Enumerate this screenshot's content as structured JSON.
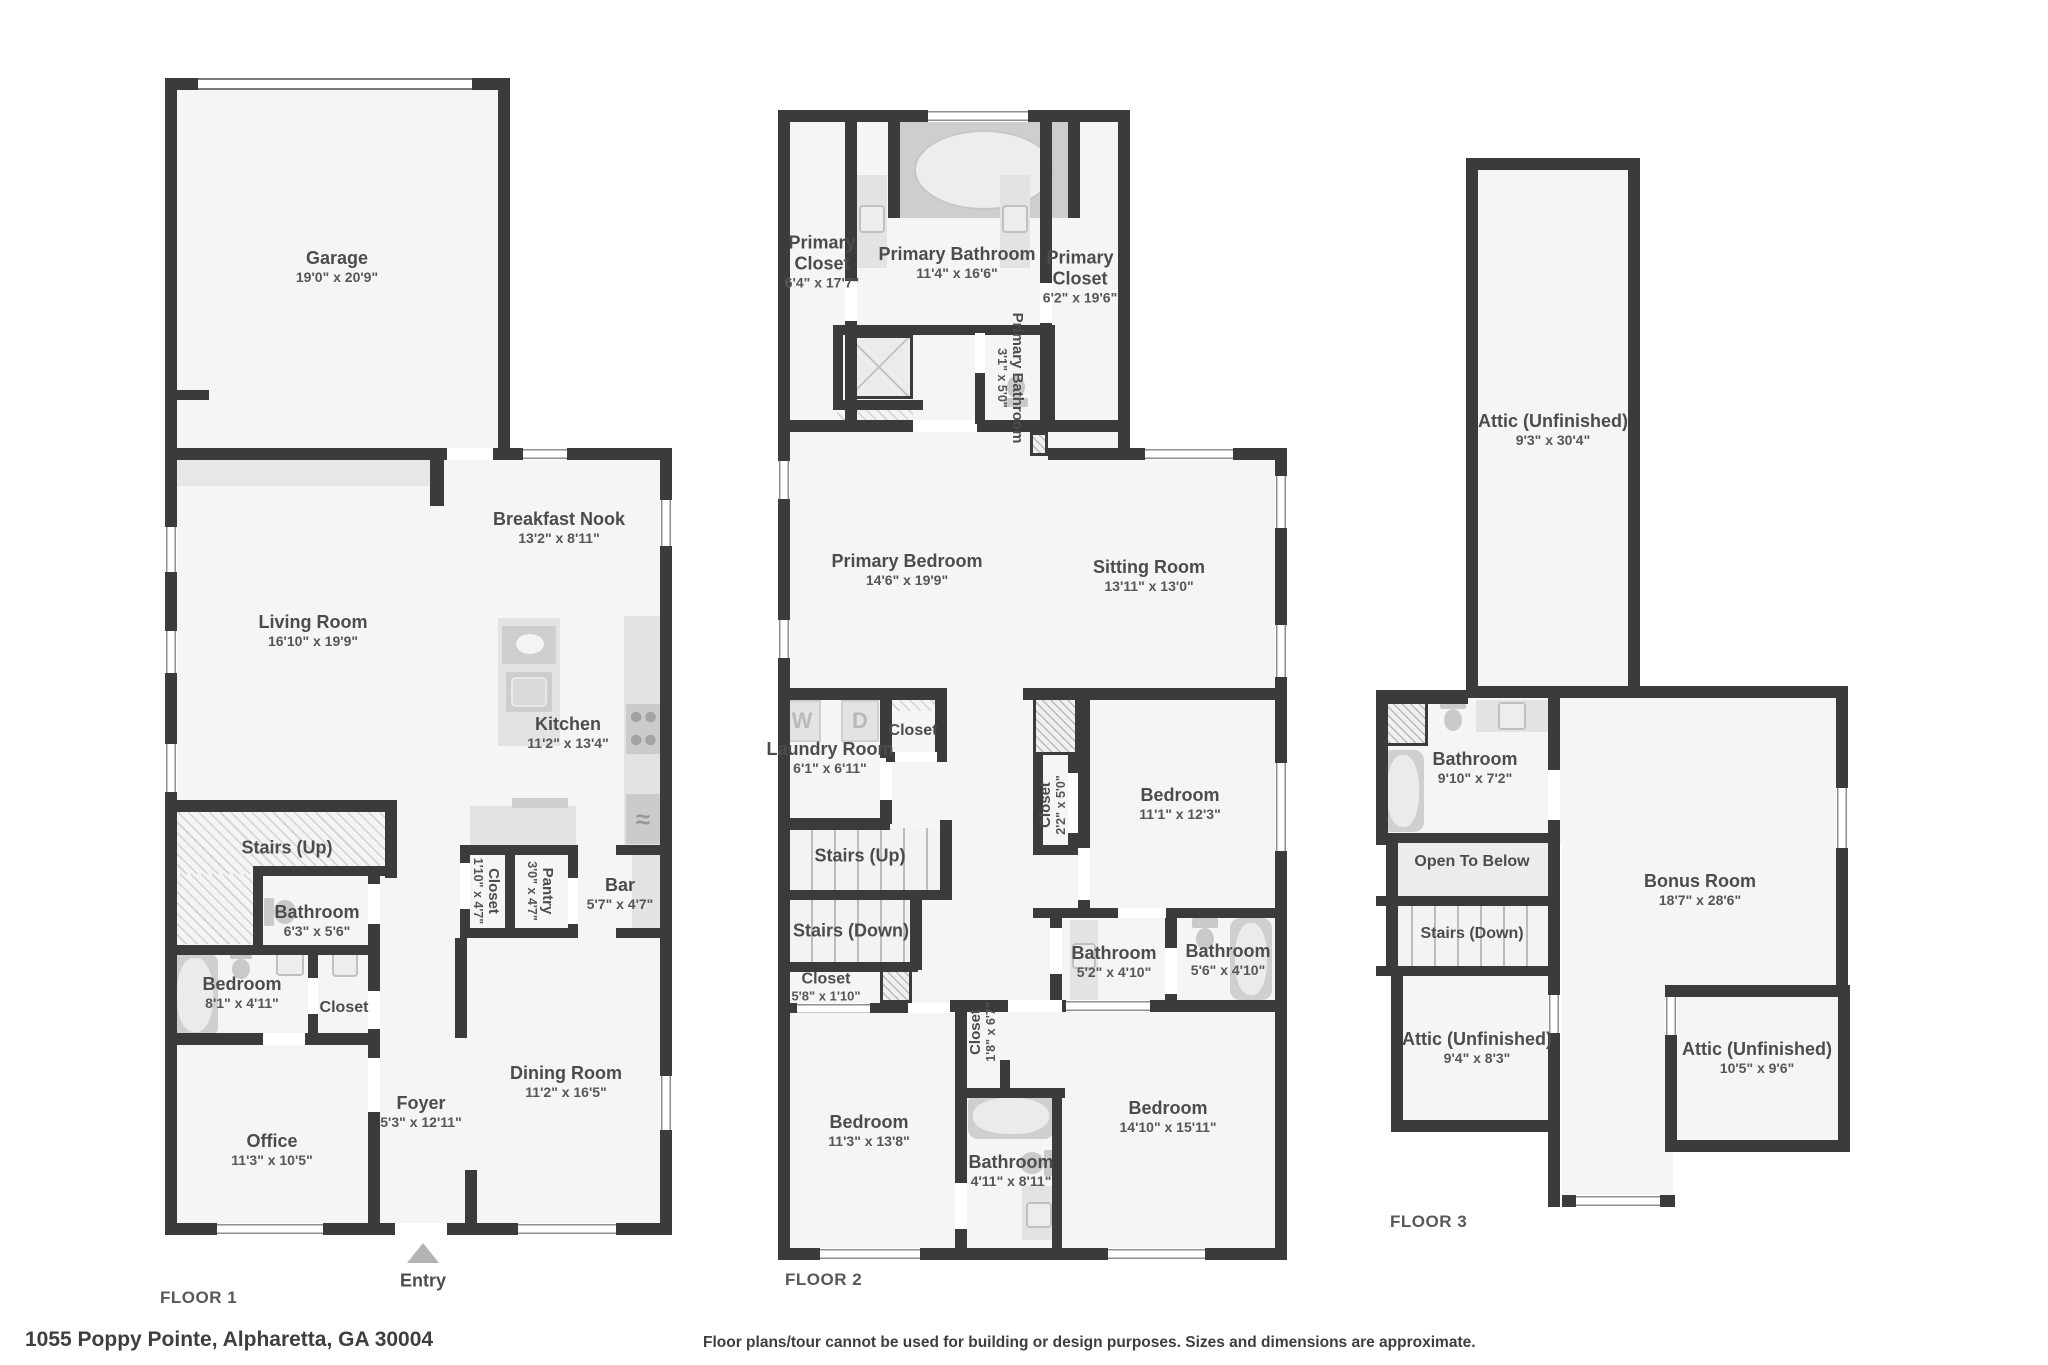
{
  "address": "1055 Poppy Pointe, Alpharetta, GA 30004",
  "disclaimer": "Floor plans/tour cannot be used for building or design purposes. Sizes and dimensions are approximate.",
  "icons": {
    "washer": "W",
    "dryer": "D",
    "fridge": "≈"
  },
  "f1": {
    "caption": "FLOOR 1",
    "entry": "Entry",
    "garage": {
      "name": "Garage",
      "dims": "19'0\" x 20'9\""
    },
    "breakfast_nook": {
      "name": "Breakfast Nook",
      "dims": "13'2\" x 8'11\""
    },
    "living_room": {
      "name": "Living Room",
      "dims": "16'10\" x 19'9\""
    },
    "kitchen": {
      "name": "Kitchen",
      "dims": "11'2\" x 13'4\""
    },
    "stairs_up": {
      "name": "Stairs (Up)"
    },
    "bathroom": {
      "name": "Bathroom",
      "dims": "6'3\" x 5'6\""
    },
    "bedroom": {
      "name": "Bedroom",
      "dims": "8'1\" x 4'11\""
    },
    "closet": {
      "name": "Closet"
    },
    "closet2": {
      "name": "Closet",
      "dims": "1'10\" x 4'7\""
    },
    "pantry": {
      "name": "Pantry",
      "dims": "3'0\" x 4'7\""
    },
    "bar": {
      "name": "Bar",
      "dims": "5'7\" x 4'7\""
    },
    "office": {
      "name": "Office",
      "dims": "11'3\" x 10'5\""
    },
    "foyer": {
      "name": "Foyer",
      "dims": "5'3\" x 12'11\""
    },
    "dining_room": {
      "name": "Dining Room",
      "dims": "11'2\" x 16'5\""
    }
  },
  "f2": {
    "caption": "FLOOR 2",
    "primary_closet_left": {
      "name": "Primary Closet",
      "dims": "6'4\" x 17'7\""
    },
    "primary_bathroom": {
      "name": "Primary Bathroom",
      "dims": "11'4\" x 16'6\""
    },
    "primary_closet_right": {
      "name": "Primary Closet",
      "dims": "6'2\" x 19'6\""
    },
    "primary_bathroom_wc": {
      "name": "Primary Bathroom",
      "dims": "3'1\" x 5'0\""
    },
    "primary_bedroom": {
      "name": "Primary Bedroom",
      "dims": "14'6\" x 19'9\""
    },
    "sitting_room": {
      "name": "Sitting Room",
      "dims": "13'11\" x 13'0\""
    },
    "laundry": {
      "name": "Laundry Room",
      "dims": "6'1\" x 6'11\""
    },
    "closet_top": {
      "name": "Closet"
    },
    "closet_225": {
      "name": "Closet",
      "dims": "2'2\" x 5'0\""
    },
    "stairs_up": {
      "name": "Stairs (Up)"
    },
    "stairs_down": {
      "name": "Stairs (Down)"
    },
    "closet_58": {
      "name": "Closet",
      "dims": "5'8\" x 1'10\""
    },
    "bedroom_111": {
      "name": "Bedroom",
      "dims": "11'1\" x 12'3\""
    },
    "bathroom_52": {
      "name": "Bathroom",
      "dims": "5'2\" x 4'10\""
    },
    "bathroom_56": {
      "name": "Bathroom",
      "dims": "5'6\" x 4'10\""
    },
    "closet_18": {
      "name": "Closet",
      "dims": "1'8\" x 6'7\""
    },
    "bedroom_113": {
      "name": "Bedroom",
      "dims": "11'3\" x 13'8\""
    },
    "bathroom_411": {
      "name": "Bathroom",
      "dims": "4'11\" x 8'11\""
    },
    "bedroom_1410": {
      "name": "Bedroom",
      "dims": "14'10\" x 15'11\""
    }
  },
  "f3": {
    "caption": "FLOOR 3",
    "attic_top": {
      "name": "Attic (Unfinished)",
      "dims": "9'3\" x 30'4\""
    },
    "bathroom": {
      "name": "Bathroom",
      "dims": "9'10\" x 7'2\""
    },
    "open_below": {
      "name": "Open To Below"
    },
    "stairs_down": {
      "name": "Stairs (Down)"
    },
    "bonus": {
      "name": "Bonus Room",
      "dims": "18'7\" x 28'6\""
    },
    "attic_left": {
      "name": "Attic (Unfinished)",
      "dims": "9'4\" x 8'3\""
    },
    "attic_right": {
      "name": "Attic (Unfinished)",
      "dims": "10'5\" x 9'6\""
    }
  }
}
